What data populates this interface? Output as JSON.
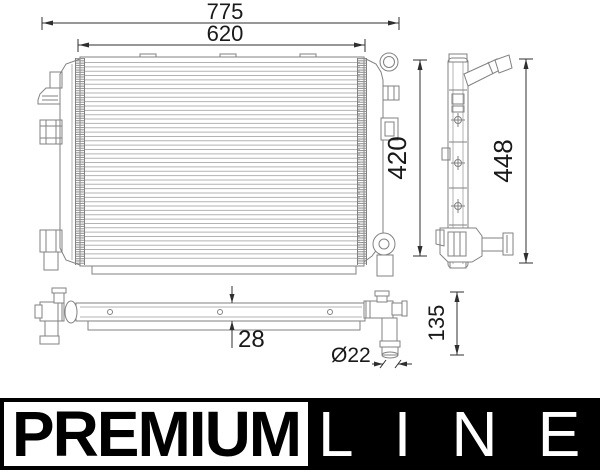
{
  "dimensions": {
    "overall_width": "775",
    "core_width": "620",
    "core_height": "420",
    "overall_height": "448",
    "core_depth": "28",
    "pipe_diameter": "Ø22",
    "lower_view_height": "135"
  },
  "logo": {
    "premium": "PREMIUM",
    "line": "LINE"
  },
  "colors": {
    "background": "#ffffff",
    "part_line": "#828282",
    "fin_line": "#b3b3b3",
    "hatch_line": "#969696",
    "dimension_line": "#2f2f2f",
    "dimension_text": "#191919",
    "logo_bar": "#000000",
    "logo_premium_bg": "#ffffff",
    "logo_premium_text": "#000000",
    "logo_line_text": "#ffffff"
  }
}
